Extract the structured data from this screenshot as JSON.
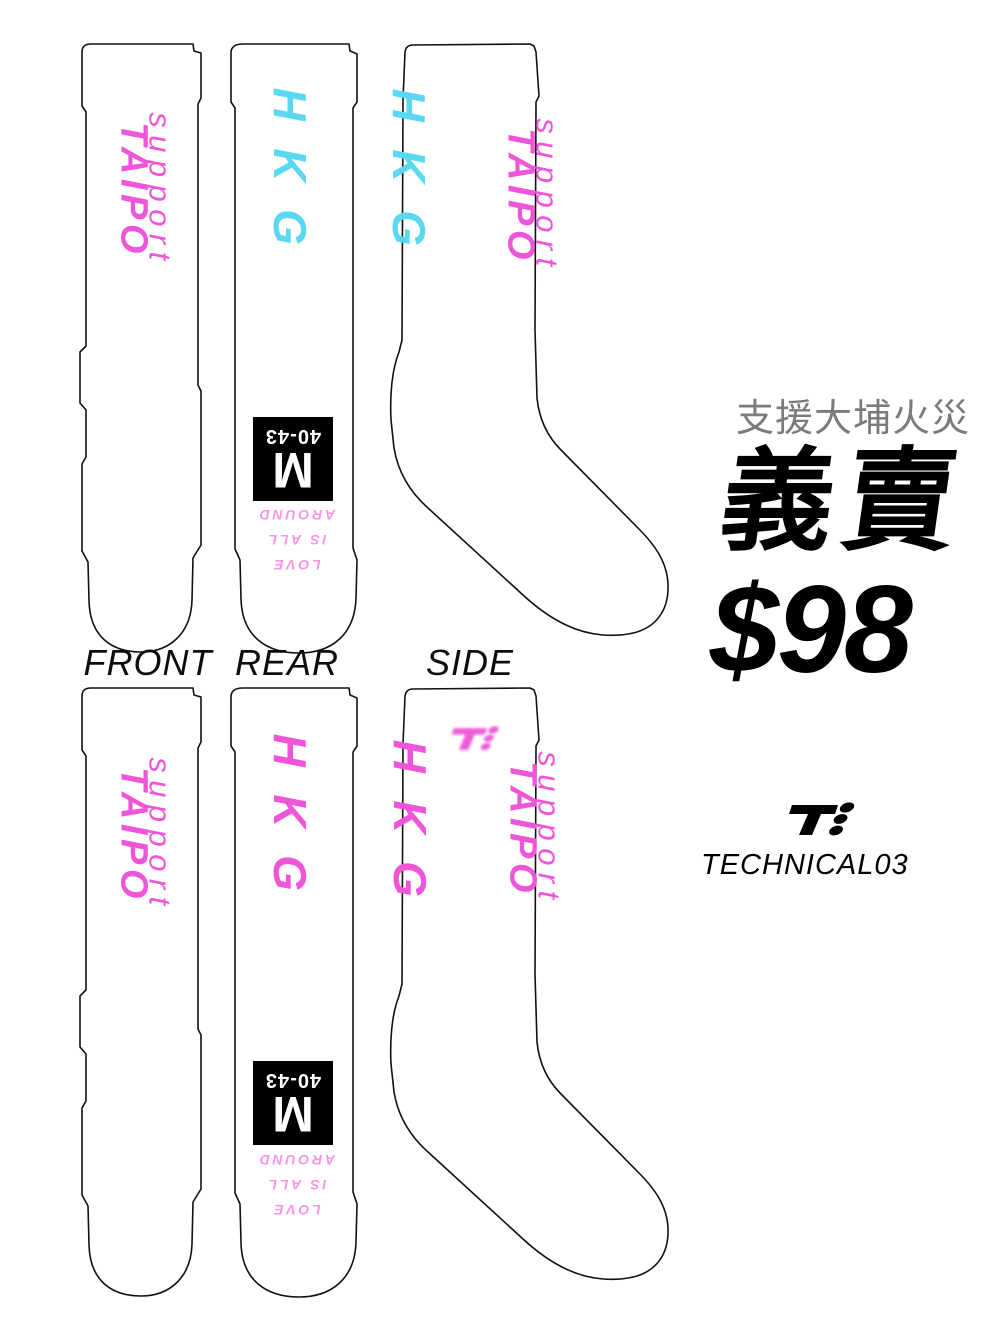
{
  "product": {
    "front_text": {
      "line1": "support",
      "line2": "TAIPO"
    },
    "city_text": "HKG",
    "size_label": {
      "letter": "M",
      "range": "40-43"
    },
    "slogan": {
      "line1": "LOVE",
      "line2": "IS ALL",
      "line3": "AROUND"
    }
  },
  "views": {
    "front": "FRONT",
    "rear": "REAR",
    "side": "SIDE"
  },
  "promo": {
    "subtitle": "支援大埔火災",
    "title": "義賣",
    "price": "$98"
  },
  "brand": {
    "name": "TECHNICAL03",
    "logo_glyph": "T with three dots"
  },
  "colors": {
    "pink": "#ee55d8",
    "cyan": "#5ad8f2",
    "light_pink": "#fc94e4",
    "gray": "#7b7b7b",
    "outline": "#111111"
  }
}
